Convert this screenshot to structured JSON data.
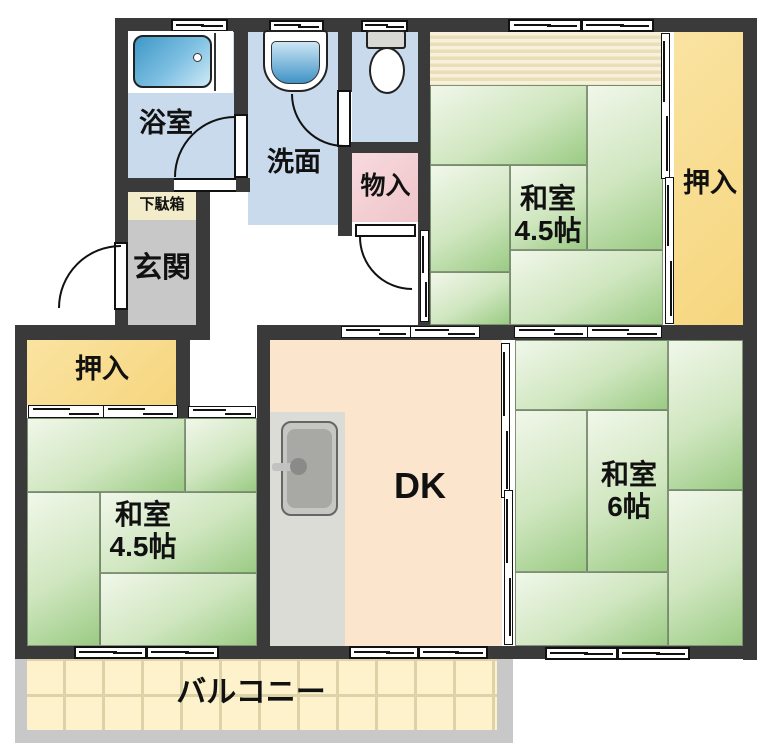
{
  "plan": {
    "rooms": {
      "bathroom": {
        "label": "浴室"
      },
      "washroom": {
        "label": "洗面"
      },
      "storage": {
        "label": "物入"
      },
      "shoe_cabinet": {
        "label": "下駄箱"
      },
      "entrance": {
        "label": "玄関"
      },
      "closet_left": {
        "label": "押入"
      },
      "closet_right": {
        "label": "押入"
      },
      "tatami_top_right": {
        "name": "和室",
        "size": "4.5帖"
      },
      "tatami_bottom_left": {
        "name": "和室",
        "size": "4.5帖"
      },
      "tatami_right": {
        "name": "和室",
        "size": "6帖"
      },
      "dining_kitchen": {
        "label": "DK"
      },
      "balcony": {
        "label": "バルコニー"
      }
    },
    "fixtures": [
      "bathtub",
      "washbasin",
      "toilet",
      "kitchen-sink"
    ],
    "colors": {
      "wall": "#3a3a3a",
      "water_room": "#c9daec",
      "tatami_green": "#9bcb84",
      "closet_yellow": "#f8dc92",
      "dk_peach": "#fbe5cd",
      "storage_pink": "#f3ced2",
      "entrance_gray": "#c8c8c8",
      "shoe_cabinet_cream": "#f2ecca",
      "balcony_tile": "#fdf2cc",
      "balcony_frame": "#c8c8c8",
      "tub_blue": "#3e98c8",
      "counter_gray": "#dcdcd7"
    }
  }
}
